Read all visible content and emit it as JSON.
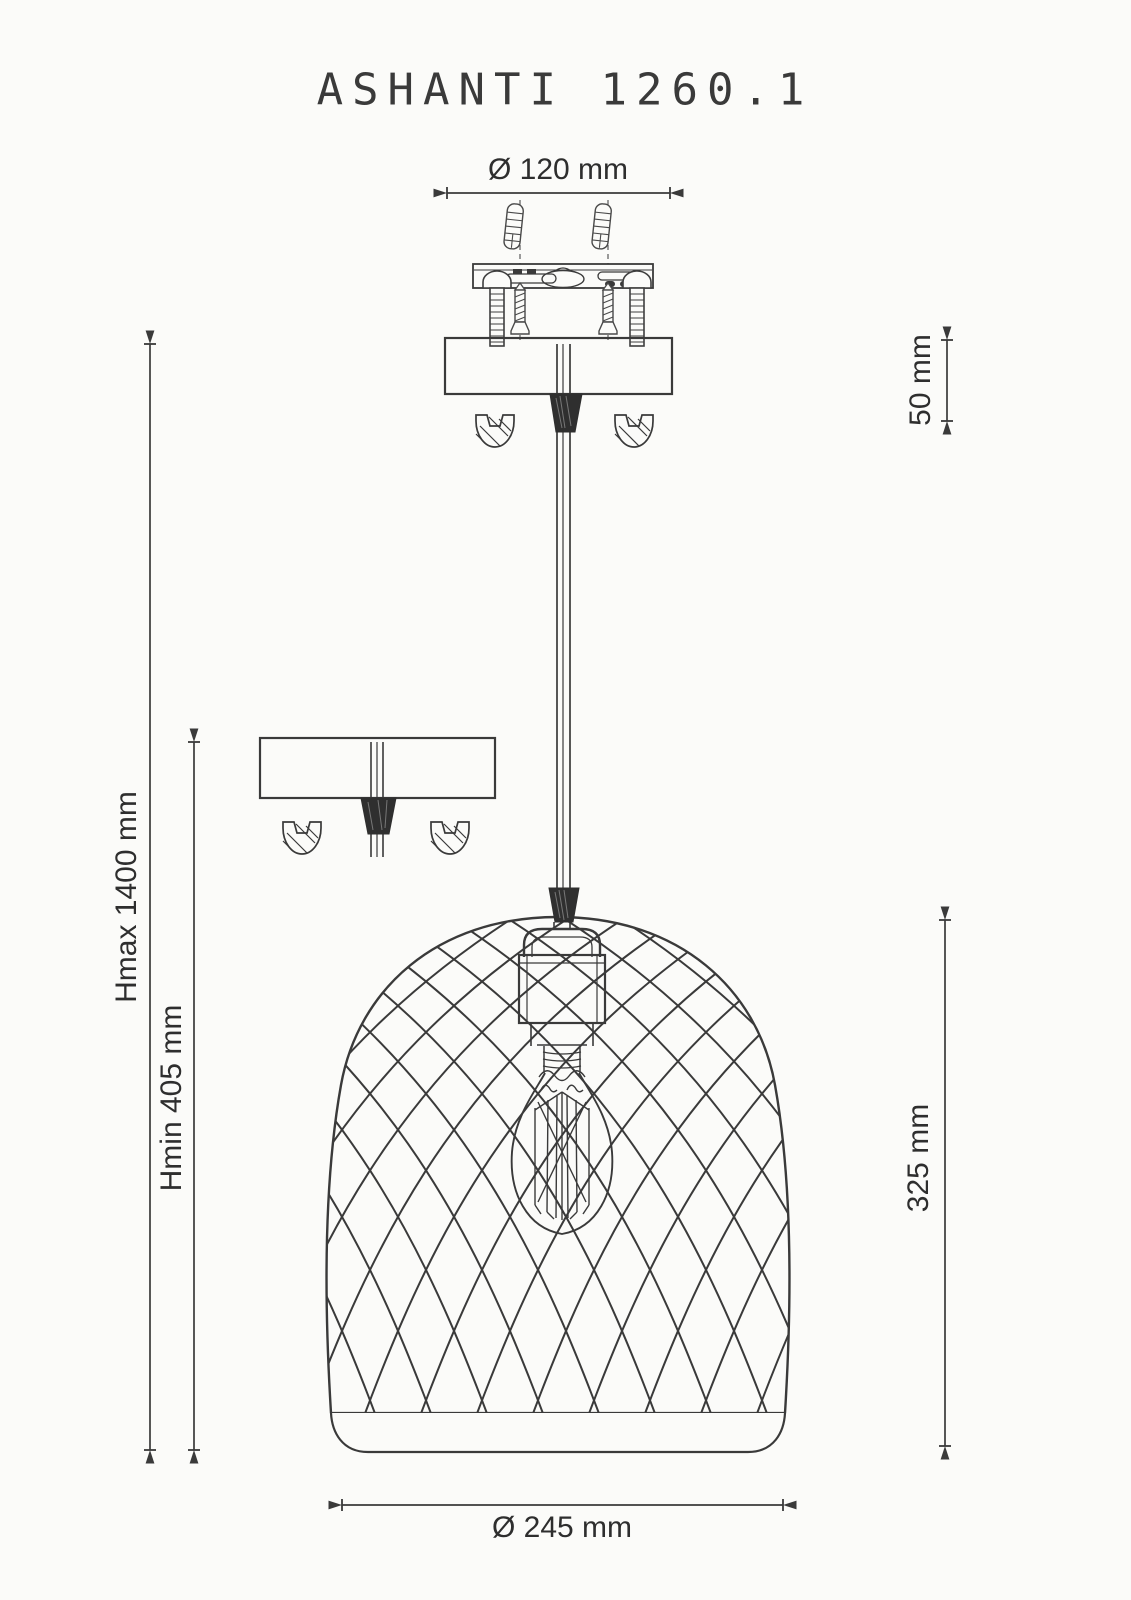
{
  "title": "ASHANTI 1260.1",
  "dimensions": {
    "mount_diameter": "Ø 120 mm",
    "canopy_height": "50 mm",
    "max_height": "Hmax 1400 mm",
    "min_height": "Hmin 405 mm",
    "shade_height": "325 mm",
    "shade_diameter": "Ø 245 mm"
  },
  "colors": {
    "line": "#3a3a3a",
    "dark_fill": "#2f2f2f",
    "background": "#fbfbf9",
    "text": "#2e2e2e"
  }
}
